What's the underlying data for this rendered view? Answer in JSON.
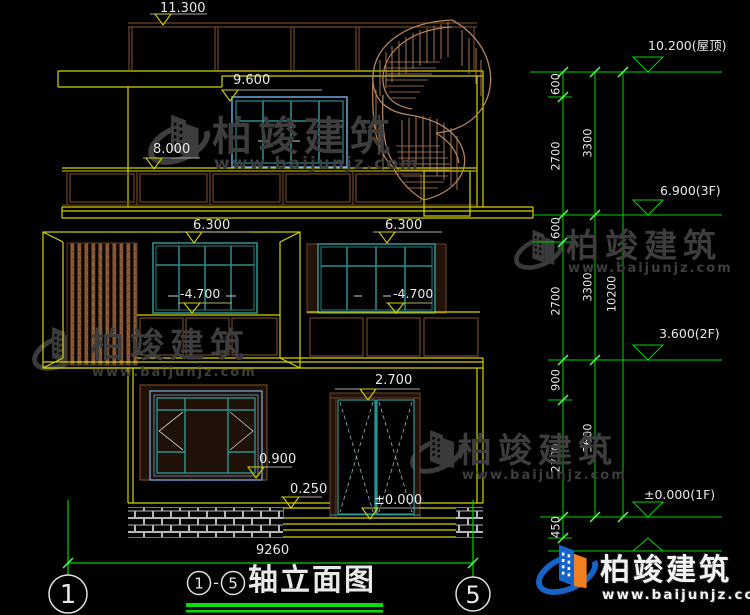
{
  "watermark": {
    "brand": "柏竣建筑",
    "site": "www.baijunjz.com"
  },
  "footer": {
    "axis_left": "1",
    "axis_right": "5",
    "circle_1": "1",
    "dash": "-",
    "circle_5": "5",
    "title": "轴立面图",
    "overall_width": "9260"
  },
  "elevation_markers": {
    "m11300": "11.300",
    "m9600": "9.600",
    "m8000": "8.000",
    "m6300_left": "6.300",
    "m6300_right": "6.300",
    "m4700_left": "-4.700",
    "m4700_right": "-4.700",
    "m2700": "2.700",
    "m0900": "0.900",
    "m0250": "0.250",
    "m0000": "±0.000"
  },
  "right_dims": {
    "levels": {
      "roof": "10.200(屋顶)",
      "f3": "6.900(3F)",
      "f2": "3.600(2F)",
      "f1": "±0.000(1F)"
    },
    "inner": [
      "600",
      "2700",
      "600",
      "2700",
      "900",
      "2700",
      "450"
    ],
    "mid": [
      "3300",
      "3300",
      "3600"
    ],
    "outer": "10200"
  },
  "colors": {
    "background": "#000000",
    "outline_yellow": "#d4d400",
    "window_teal": "#2a8f8f",
    "window_blue": "#6a9ad0",
    "railing_brown": "#6e4526",
    "stair_tan": "#b5835a",
    "dimension_green": "#00d400",
    "text_white": "#e8e8e8",
    "logo_blue": "#1565c8",
    "logo_orange": "#f08020"
  }
}
